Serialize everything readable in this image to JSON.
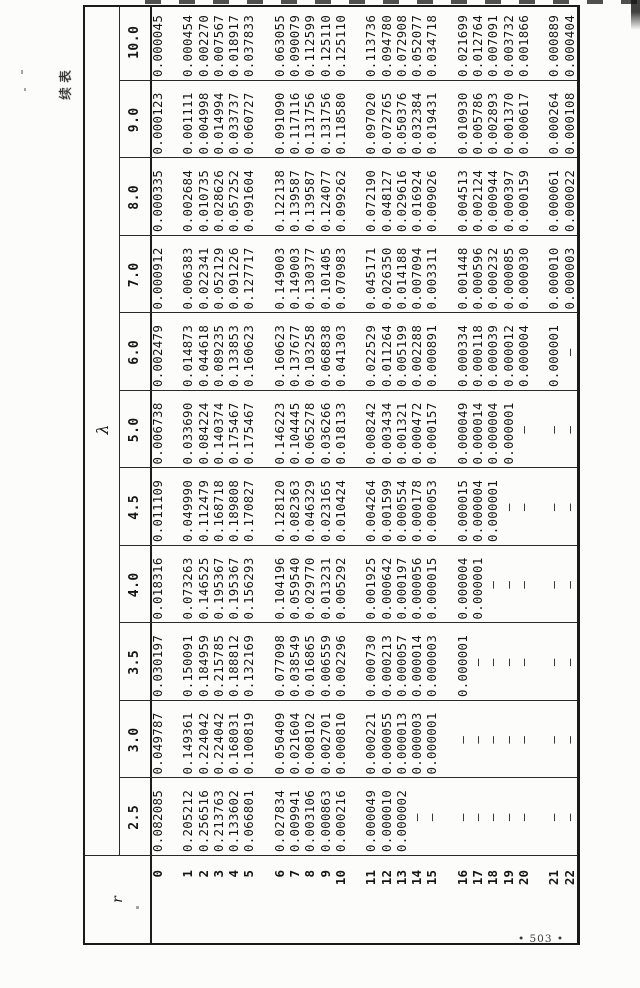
{
  "page": {
    "continuation_label": "续表",
    "page_number": "• 503 •"
  },
  "table": {
    "corner_label": "r",
    "lambda_symbol": "λ",
    "r_labels": [
      "0",
      "1",
      "2",
      "3",
      "4",
      "5",
      "6",
      "7",
      "8",
      "9",
      "10",
      "11",
      "12",
      "13",
      "14",
      "15",
      "16",
      "17",
      "18",
      "19",
      "20",
      "21",
      "22"
    ],
    "group_break_after": [
      0,
      5,
      10,
      15,
      20
    ],
    "columns": [
      {
        "lambda": "2.5",
        "values": [
          "0.082085",
          "0.205212",
          "0.256516",
          "0.213763",
          "0.133602",
          "0.066801",
          "0.027834",
          "0.009941",
          "0.003106",
          "0.000863",
          "0.000216",
          "0.000049",
          "0.000010",
          "0.000002",
          "—",
          "—",
          "—",
          "—",
          "—",
          "—",
          "—",
          "—",
          "—"
        ]
      },
      {
        "lambda": "3.0",
        "values": [
          "0.049787",
          "0.149361",
          "0.224042",
          "0.224042",
          "0.168031",
          "0.100819",
          "0.050409",
          "0.021604",
          "0.008102",
          "0.002701",
          "0.000810",
          "0.000221",
          "0.000055",
          "0.000013",
          "0.000003",
          "0.000001",
          "—",
          "—",
          "—",
          "—",
          "—",
          "—",
          "—"
        ]
      },
      {
        "lambda": "3.5",
        "values": [
          "0.030197",
          "0.150091",
          "0.184959",
          "0.215785",
          "0.188812",
          "0.132169",
          "0.077098",
          "0.038549",
          "0.016865",
          "0.006559",
          "0.002296",
          "0.000730",
          "0.000213",
          "0.000057",
          "0.000014",
          "0.000003",
          "0.000001",
          "—",
          "—",
          "—",
          "—",
          "—",
          "—"
        ]
      },
      {
        "lambda": "4.0",
        "values": [
          "0.018316",
          "0.073263",
          "0.146525",
          "0.195367",
          "0.195367",
          "0.156293",
          "0.104196",
          "0.059540",
          "0.029770",
          "0.013231",
          "0.005292",
          "0.001925",
          "0.000642",
          "0.000197",
          "0.000056",
          "0.000015",
          "0.000004",
          "0.000001",
          "—",
          "—",
          "—",
          "—",
          "—"
        ]
      },
      {
        "lambda": "4.5",
        "values": [
          "0.011109",
          "0.049990",
          "0.112479",
          "0.168718",
          "0.189808",
          "0.170827",
          "0.128120",
          "0.082363",
          "0.046329",
          "0.023165",
          "0.010424",
          "0.004264",
          "0.001599",
          "0.000554",
          "0.000178",
          "0.000053",
          "0.000015",
          "0.000004",
          "0.000001",
          "—",
          "—",
          "—",
          "—"
        ]
      },
      {
        "lambda": "5.0",
        "values": [
          "0.006738",
          "0.033690",
          "0.084224",
          "0.140374",
          "0.175467",
          "0.175467",
          "0.146223",
          "0.104445",
          "0.065278",
          "0.036266",
          "0.018133",
          "0.008242",
          "0.003434",
          "0.001321",
          "0.000472",
          "0.000157",
          "0.000049",
          "0.000014",
          "0.000004",
          "0.000001",
          "—",
          "—",
          "—"
        ]
      },
      {
        "lambda": "6.0",
        "values": [
          "0.002479",
          "0.014873",
          "0.044618",
          "0.089235",
          "0.133853",
          "0.160623",
          "0.160623",
          "0.137677",
          "0.103258",
          "0.068838",
          "0.041303",
          "0.022529",
          "0.011264",
          "0.005199",
          "0.002288",
          "0.000891",
          "0.000334",
          "0.000118",
          "0.000039",
          "0.000012",
          "0.000004",
          "0.000001",
          "—"
        ]
      },
      {
        "lambda": "7.0",
        "values": [
          "0.000912",
          "0.006383",
          "0.022341",
          "0.052129",
          "0.091226",
          "0.127717",
          "0.149003",
          "0.149003",
          "0.130377",
          "0.101405",
          "0.070983",
          "0.045171",
          "0.026350",
          "0.014188",
          "0.007094",
          "0.003311",
          "0.001448",
          "0.000596",
          "0.000232",
          "0.000085",
          "0.000030",
          "0.000010",
          "0.000003"
        ]
      },
      {
        "lambda": "8.0",
        "values": [
          "0.000335",
          "0.002684",
          "0.010735",
          "0.028626",
          "0.057252",
          "0.091604",
          "0.122138",
          "0.139587",
          "0.139587",
          "0.124077",
          "0.099262",
          "0.072190",
          "0.048127",
          "0.029616",
          "0.016924",
          "0.009026",
          "0.004513",
          "0.002124",
          "0.000944",
          "0.000397",
          "0.000159",
          "0.000061",
          "0.000022"
        ]
      },
      {
        "lambda": "9.0",
        "values": [
          "0.000123",
          "0.001111",
          "0.004998",
          "0.014994",
          "0.033737",
          "0.060727",
          "0.091090",
          "0.117116",
          "0.131756",
          "0.131756",
          "0.118580",
          "0.097020",
          "0.072765",
          "0.050376",
          "0.032384",
          "0.019431",
          "0.010930",
          "0.005786",
          "0.002893",
          "0.001370",
          "0.000617",
          "0.000264",
          "0.000108"
        ]
      },
      {
        "lambda": "10.0",
        "values": [
          "0.000045",
          "0.000454",
          "0.002270",
          "0.007567",
          "0.018917",
          "0.037833",
          "0.063055",
          "0.090079",
          "0.112599",
          "0.125110",
          "0.125110",
          "0.113736",
          "0.094780",
          "0.072908",
          "0.052077",
          "0.034718",
          "0.021699",
          "0.012764",
          "0.007091",
          "0.003732",
          "0.001866",
          "0.000889",
          "0.000404"
        ]
      }
    ]
  }
}
